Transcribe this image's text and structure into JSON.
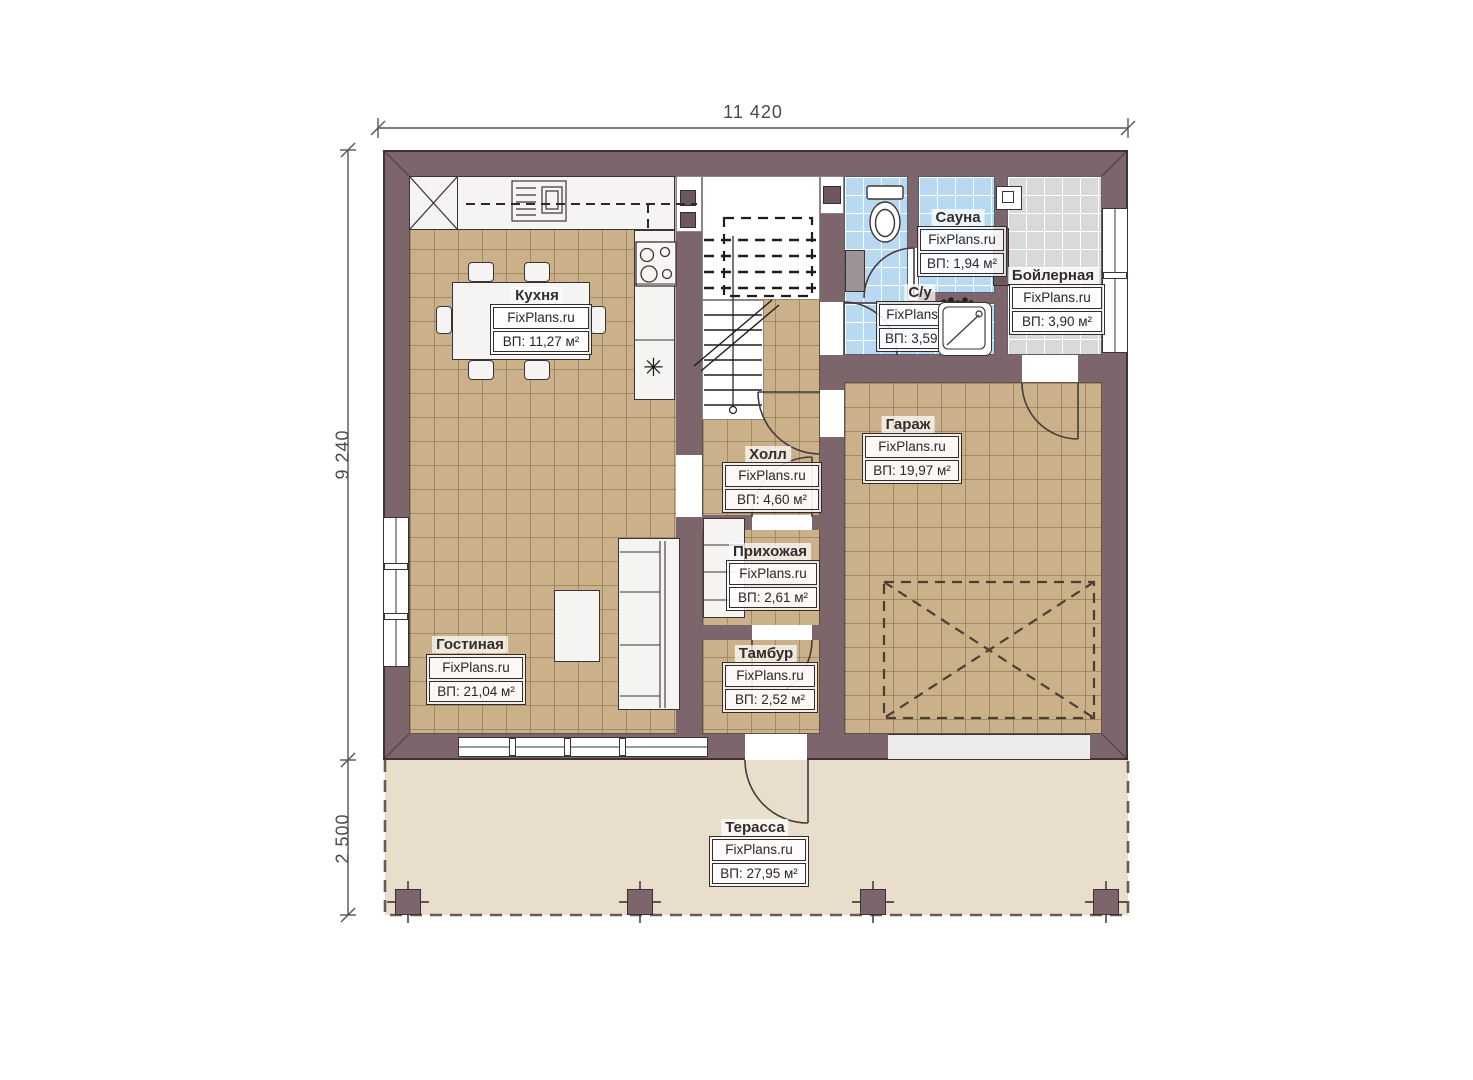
{
  "brand": "FixPlans.ru",
  "dimensions": {
    "total_width": "11 420",
    "main_depth": "9 240",
    "terrace_depth": "2 500"
  },
  "icons": {
    "fridge_snowflake": "✳"
  },
  "rooms": {
    "kitchen": {
      "name": "Кухня",
      "area": "ВП: 11,27 м²"
    },
    "sauna": {
      "name": "Сауна",
      "area": "ВП: 1,94 м²"
    },
    "boiler": {
      "name": "Бойлерная",
      "area": "ВП: 3,90 м²"
    },
    "wc": {
      "name": "С/у",
      "area": "ВП: 3,59 м²"
    },
    "garage": {
      "name": "Гараж",
      "area": "ВП: 19,97 м²"
    },
    "hall": {
      "name": "Холл",
      "area": "ВП: 4,60 м²"
    },
    "entryhall": {
      "name": "Прихожая",
      "area": "ВП: 2,61 м²"
    },
    "living": {
      "name": "Гостиная",
      "area": "ВП: 21,04 м²"
    },
    "tambour": {
      "name": "Тамбур",
      "area": "ВП: 2,52 м²"
    },
    "terrace": {
      "name": "Терасса",
      "area": "ВП: 27,95 м²"
    }
  },
  "colors": {
    "wall": "#7c666b",
    "floor_tile": "#cbb189",
    "wet_tile": "#b9d9f0",
    "boiler_tile": "#d9d9d9",
    "terrace": "#e8decb"
  }
}
